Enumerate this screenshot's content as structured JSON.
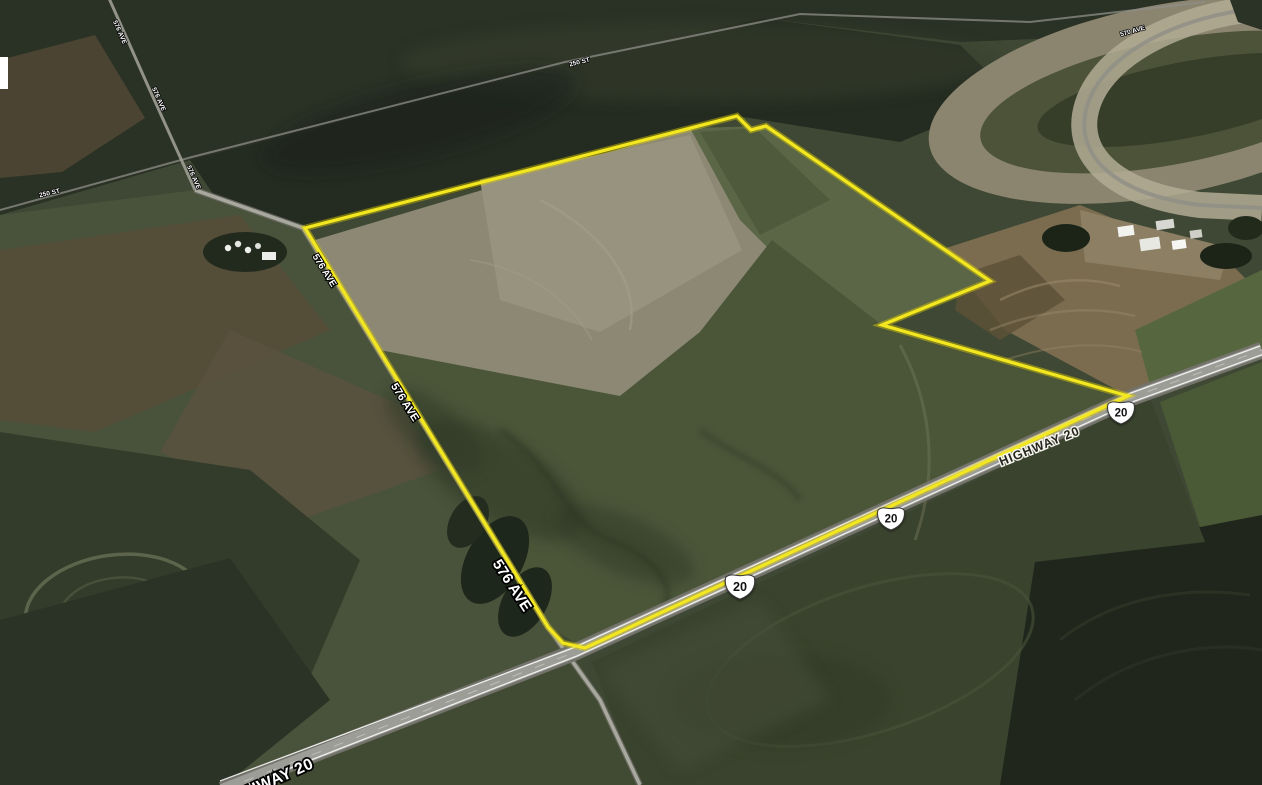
{
  "map": {
    "view_type": "oblique satellite imagery",
    "colors": {
      "boundary": "#f3e71f",
      "boundary_glow": "#d9ca06",
      "label_white": "#ffffff",
      "label_dark": "#26261f",
      "shield_fill": "#ffffff",
      "shield_outline": "#3a3a3a",
      "shield_number_color": "#111111",
      "highway_pavement": "#9d9d97",
      "minor_road": "#a8a89f"
    },
    "boundary": {
      "points_str": "305,228 737,116 751,130 766,126 990,281 882,325 1128,396 585,648 563,643 548,627",
      "closed": true
    },
    "road_labels": [
      {
        "text": "576 AVE",
        "x": 118,
        "y": 33,
        "angle": 66,
        "size": 6.5,
        "style": "light"
      },
      {
        "text": "576 AVE",
        "x": 157,
        "y": 100,
        "angle": 66,
        "size": 6.5,
        "style": "light"
      },
      {
        "text": "576 AVE",
        "x": 192,
        "y": 178,
        "angle": 66,
        "size": 6.5,
        "style": "light"
      },
      {
        "text": "250 ST",
        "x": 580,
        "y": 64,
        "angle": -14,
        "size": 6.5,
        "style": "light"
      },
      {
        "text": "250 ST",
        "x": 50,
        "y": 195,
        "angle": -13,
        "size": 6.5,
        "style": "light"
      },
      {
        "text": "570 AVE",
        "x": 1133,
        "y": 33,
        "angle": -16,
        "size": 6.5,
        "style": "light"
      },
      {
        "text": "576 AVE",
        "x": 322,
        "y": 272,
        "angle": 58,
        "size": 9.5,
        "style": "light"
      },
      {
        "text": "576 AVE",
        "x": 402,
        "y": 404,
        "angle": 58,
        "size": 11,
        "style": "light"
      },
      {
        "text": "576 AVE",
        "x": 508,
        "y": 588,
        "angle": 57,
        "size": 15,
        "style": "light"
      },
      {
        "text": "HIGHWAY 20",
        "x": 1041,
        "y": 450,
        "angle": -22,
        "size": 12.5,
        "style": "dark",
        "spacing": 1
      },
      {
        "text": "HIGHWAY 20",
        "x": 268,
        "y": 788,
        "angle": -24,
        "size": 16,
        "style": "light",
        "spacing": 0.5,
        "note_visible_part": "AY 20"
      }
    ],
    "route_shields": [
      {
        "route": "20",
        "x": 1121,
        "y": 412,
        "scale": 1.0
      },
      {
        "route": "20",
        "x": 891,
        "y": 518,
        "scale": 1.0
      },
      {
        "route": "20",
        "x": 740,
        "y": 586,
        "scale": 1.1
      }
    ],
    "artifacts": [
      {
        "type": "white-sliver",
        "x": 0,
        "y": 57,
        "w": 8,
        "h": 32
      }
    ]
  }
}
